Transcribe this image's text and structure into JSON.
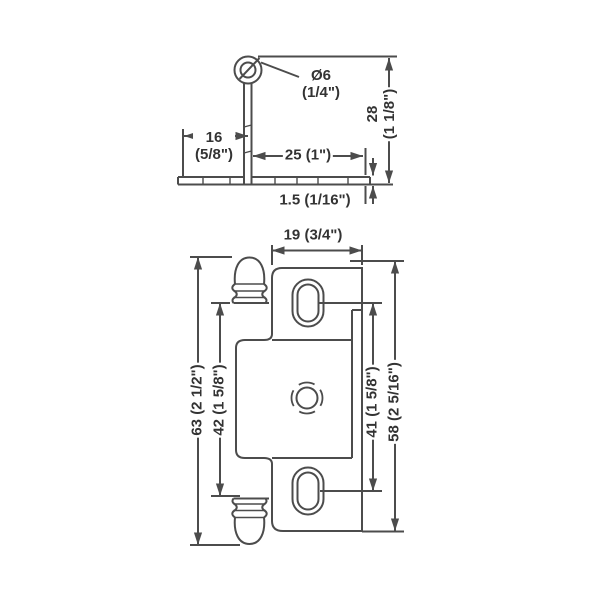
{
  "colors": {
    "line": "#4c4c4c",
    "text": "#333333",
    "background": "#ffffff"
  },
  "side_view": {
    "pin_diameter_mm": "Ø6",
    "pin_diameter_in": "(1/4\")",
    "left_flange_mm": "16",
    "left_flange_in": "(5/8\")",
    "right_flange": "25 (1\")",
    "overall_height_mm": "28",
    "overall_height_in": "(1 1/8\")",
    "plate_thickness": "1.5 (1/16\")"
  },
  "front_view": {
    "plate_width": "19 (3/4\")",
    "overall_height": "63 (2 1/2\")",
    "knuckle_gap": "42 (1 5/8\")",
    "slot_spacing": "41 (1 5/8\")",
    "plate_height": "58 (2 5/16\")"
  }
}
